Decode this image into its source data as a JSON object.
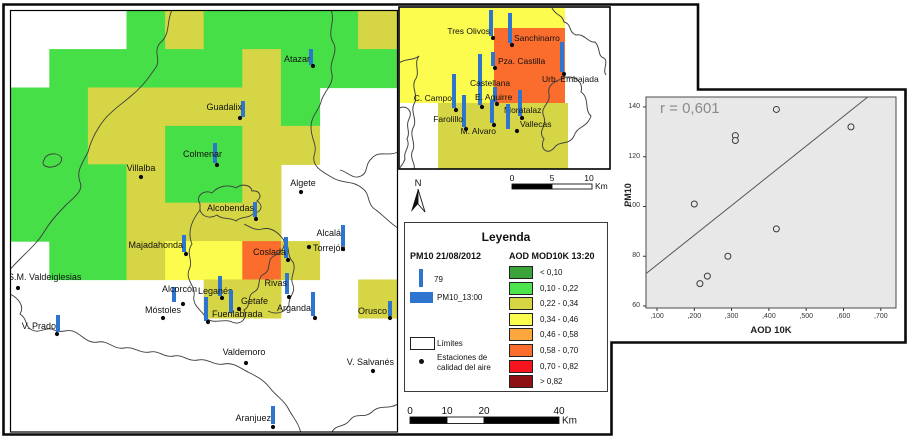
{
  "palette": {
    "G": "#47DF47",
    "Y": "#D6D545",
    "LY": "#FCFC4F",
    "O": "#FA6D2D",
    "bar_blue": "#2E75D0",
    "frame": "#0a0a0a",
    "contour": "#3c3c3c",
    "plot_bg": "#E8E8E8"
  },
  "map": {
    "grid": {
      "origin": [
        11,
        11
      ],
      "cell_w": 38.6,
      "cell_h": 38.4,
      "codes": [
        [
          "W",
          "W",
          "W",
          "G",
          "Y",
          "G",
          "G",
          "G",
          "G",
          "Y"
        ],
        [
          "W",
          "G",
          "G",
          "G",
          "G",
          "G",
          "Y",
          "G",
          "G",
          "G"
        ],
        [
          "G",
          "G",
          "Y",
          "Y",
          "Y",
          "Y",
          "Y",
          "G",
          "W",
          "W"
        ],
        [
          "G",
          "G",
          "Y",
          "Y",
          "G",
          "G",
          "Y",
          "Y",
          "W",
          "W"
        ],
        [
          "G",
          "G",
          "G",
          "Y",
          "G",
          "G",
          "Y",
          "W",
          "W",
          "W"
        ],
        [
          "G",
          "G",
          "G",
          "Y",
          "Y",
          "Y",
          "Y",
          "W",
          "W",
          "W"
        ],
        [
          "W",
          "G",
          "G",
          "Y",
          "LY",
          "LY",
          "O",
          "Y",
          "W",
          "W"
        ],
        [
          "W",
          "W",
          "W",
          "W",
          "W",
          "Y",
          "Y",
          "W",
          "W",
          "Y"
        ],
        [
          "W",
          "W",
          "W",
          "W",
          "W",
          "W",
          "W",
          "W",
          "W",
          "W"
        ],
        [
          "W",
          "W",
          "W",
          "W",
          "W",
          "W",
          "W",
          "W",
          "W",
          "W"
        ],
        [
          "W",
          "W",
          "W",
          "W",
          "W",
          "W",
          "W",
          "W",
          "W",
          "W"
        ]
      ]
    },
    "contours": [
      "M172,10 C166,22 171,34 160,43 C152,53 163,60 154,70 C147,80 141,88 131,96 C122,104 112,110 104,120 C97,129 91,140 88,152 C82,164 76,171 80,182 C84,191 73,198 65,206 C57,214 50,222 44,232 C38,242 29,250 21,258 C15,264 11,268 8,272",
      "M331,10 C336,22 326,32 334,44 C338,54 328,62 332,74 C334,85 323,92 321,102 C318,112 311,116 311,127 C311,140 318,144 314,156 C312,167 323,172 333,178 C343,184 352,180 362,188 C371,194 366,204 376,210 C384,216 391,224 398,228",
      "M398,152 C387,157 380,150 372,158 C364,165 369,172 361,176 C353,180 348,172 340,170",
      "M44,160 C46,153 57,152 61,157 C64,162 56,168 48,167 C43,166 42,163 44,160 Z",
      "M200,204 C195,196 204,189 212,193 C218,186 228,184 236,188 C242,183 251,185 252,191 C259,190 263,196 257,201 C264,205 261,213 254,213 C249,219 241,216 236,221 C230,217 222,220 217,215 C210,219 202,217 200,210 Z",
      "M200,210 C192,220 187,232 192,244 C185,254 194,260 189,270 C185,280 196,286 194,296 C192,306 202,310 206,318 C214,325 224,318 232,322 C241,326 248,318 244,310 C252,306 246,296 254,292 C262,288 256,278 264,274 C272,270 266,260 274,256 C282,252 287,245 283,239 C277,231 270,227 262,229 C256,231 250,227 244,224 M283,239 C291,245 286,256 293,262 C297,270 289,277 293,285 C296,293 288,297 289,305 C285,313 276,315 268,311",
      "M10,294 C18,298 25,306 20,314 C28,319 24,326 32,330 C40,334 46,326 54,330 C62,334 67,328 75,332 C83,336 88,344 98,342 C108,340 114,350 124,348 C134,346 140,354 150,352 C159,350 164,358 174,356 C183,354 188,362 198,360 C208,358 214,366 224,364 C233,362 240,368 248,372 C256,376 264,380 270,388 C276,396 284,400 288,408 C292,416 298,422 300,430 C302,436 304,440 305,442",
      "M398,404 C388,410 380,404 372,412 C364,419 356,412 350,420 C344,428 336,424 332,432 C330,436 330,440 331,442"
    ],
    "stations": [
      {
        "name": "Atazar",
        "dot": [
          313,
          66
        ],
        "bar": [
          311,
          49,
          16
        ],
        "label": [
          310,
          62,
          "end"
        ]
      },
      {
        "name": "Guadalix",
        "dot": [
          240,
          118
        ],
        "bar": [
          243,
          101,
          16
        ],
        "label": [
          242,
          110,
          "end"
        ]
      },
      {
        "name": "Colmenar",
        "dot": [
          217,
          165
        ],
        "bar": [
          215,
          143,
          20
        ],
        "label": [
          222,
          157,
          "end"
        ]
      },
      {
        "name": "Villalba",
        "dot": [
          141,
          177
        ],
        "bar": null,
        "label": [
          141,
          171,
          "middle"
        ]
      },
      {
        "name": "Algete",
        "dot": [
          301,
          192
        ],
        "bar": null,
        "label": [
          303,
          186,
          "middle"
        ]
      },
      {
        "name": "Alcobendas",
        "dot": [
          256,
          219
        ],
        "bar": [
          255,
          202,
          15
        ],
        "label": [
          254,
          211,
          "end"
        ]
      },
      {
        "name": "Majadahonda",
        "dot": [
          186,
          254
        ],
        "bar": [
          184,
          235,
          17
        ],
        "label": [
          183,
          248,
          "end"
        ]
      },
      {
        "name": "Coslada",
        "dot": [
          288,
          260
        ],
        "bar": [
          286,
          237,
          21
        ],
        "label": [
          286,
          255,
          "end"
        ]
      },
      {
        "name": "Alcalá",
        "dot": [
          343,
          249
        ],
        "bar": [
          343,
          225,
          21
        ],
        "label": [
          341,
          236,
          "end"
        ]
      },
      {
        "name": "Torrejón",
        "dot": [
          309,
          247
        ],
        "bar": null,
        "label": [
          313,
          251,
          "start"
        ]
      },
      {
        "name": "Rivas",
        "dot": [
          289,
          297
        ],
        "bar": [
          287,
          273,
          21
        ],
        "label": [
          287,
          286,
          "end"
        ]
      },
      {
        "name": "Alcorcón",
        "dot": [
          183,
          304
        ],
        "bar": [
          174,
          287,
          15
        ],
        "label": [
          197,
          292,
          "end"
        ]
      },
      {
        "name": "Leganés",
        "dot": [
          222,
          298
        ],
        "bar": [
          220,
          276,
          20
        ],
        "label": [
          198,
          294,
          "start"
        ]
      },
      {
        "name": "Getafe",
        "dot": [
          239,
          309
        ],
        "bar": [
          231,
          290,
          23
        ],
        "label": [
          241,
          304,
          "start"
        ]
      },
      {
        "name": "Fuenlabrada",
        "dot": [
          208,
          322
        ],
        "bar": [
          206,
          297,
          24
        ],
        "label": [
          212,
          317,
          "start"
        ]
      },
      {
        "name": "Móstoles",
        "dot": [
          163,
          318
        ],
        "bar": null,
        "label": [
          163,
          313,
          "middle"
        ]
      },
      {
        "name": "Arganda",
        "dot": [
          315,
          318
        ],
        "bar": [
          313,
          292,
          24
        ],
        "label": [
          311,
          311,
          "end"
        ]
      },
      {
        "name": "Orusco",
        "dot": [
          390,
          318
        ],
        "bar": [
          390,
          301,
          15
        ],
        "label": [
          387,
          314,
          "end"
        ]
      },
      {
        "name": "V. Prado",
        "dot": [
          57,
          334
        ],
        "bar": [
          58,
          315,
          17
        ],
        "label": [
          56,
          329,
          "end"
        ]
      },
      {
        "name": "S.M. Valdeiglesias",
        "dot": [
          18,
          288
        ],
        "bar": null,
        "label": [
          8,
          280,
          "start"
        ]
      },
      {
        "name": "Valdemoro",
        "dot": [
          246,
          363
        ],
        "bar": null,
        "label": [
          244,
          355,
          "middle"
        ]
      },
      {
        "name": "V. Salvanés",
        "dot": [
          373,
          371
        ],
        "bar": null,
        "label": [
          394,
          365,
          "end"
        ]
      },
      {
        "name": "Aranjuez",
        "dot": [
          273,
          427
        ],
        "bar": [
          273,
          406,
          18
        ],
        "label": [
          271,
          421,
          "end"
        ]
      }
    ]
  },
  "inset": {
    "patches": [
      {
        "x": 400,
        "y": 8,
        "w": 94,
        "h": 95,
        "c": "LY"
      },
      {
        "x": 494,
        "y": 8,
        "w": 71,
        "h": 20,
        "c": "LY"
      },
      {
        "x": 494,
        "y": 28,
        "w": 71,
        "h": 75,
        "c": "O"
      },
      {
        "x": 438,
        "y": 103,
        "w": 130,
        "h": 66,
        "c": "Y"
      }
    ],
    "contours": [
      "M419,56 C413,64 421,72 415,80 C411,88 419,96 414,104 C410,112 418,120 413,128 C409,136 417,144 412,152 C410,160 416,164 414,169",
      "M399,63 C406,58 413,61 419,56",
      "M552,8 C556,16 562,14 564,22 C572,24 568,32 576,35 C584,33 588,43 595,42 C601,48 597,56 604,58 C609,62 602,70 606,75",
      "M563,78 C574,74 584,82 581,92 C590,98 584,110 591,116 C587,128 577,126 574,136 C569,146 559,140 554,148 C547,156 539,148 544,139 C537,131 547,127 544,117 C539,107 551,104 549,94 C547,84 555,82 563,78 Z",
      "M399,108 C407,105 413,111 409,119 C405,127 411,131 407,139 C411,147 403,151 405,159 C403,165 400,167 399,169"
    ],
    "stations": [
      {
        "name": "Tres Olivos",
        "dot": [
          493,
          38
        ],
        "bar": [
          491,
          10,
          26
        ],
        "label": [
          490,
          34,
          "end"
        ]
      },
      {
        "name": "Sanchinarro",
        "dot": [
          512,
          45
        ],
        "bar": [
          510,
          13,
          30
        ],
        "label": [
          514,
          41,
          "start"
        ]
      },
      {
        "name": "Pza. Castilla",
        "dot": [
          495,
          68
        ],
        "bar": [
          493,
          52,
          14
        ],
        "label": [
          498,
          64,
          "start"
        ]
      },
      {
        "name": "Urb. Embajada",
        "dot": [
          564,
          74
        ],
        "bar": [
          562,
          42,
          30
        ],
        "label": [
          542,
          82,
          "start"
        ]
      },
      {
        "name": "Castellana",
        "dot": [
          482,
          107
        ],
        "bar": [
          480,
          54,
          51
        ],
        "label": [
          470,
          86,
          "start"
        ]
      },
      {
        "name": "C. Campo",
        "dot": [
          456,
          110
        ],
        "bar": [
          454,
          74,
          34
        ],
        "label": [
          452,
          101,
          "end"
        ]
      },
      {
        "name": "E. Aguirre",
        "dot": [
          497,
          104
        ],
        "bar": [
          495,
          87,
          15
        ],
        "label": [
          475,
          100,
          "start"
        ]
      },
      {
        "name": "Farolillo",
        "dot": [
          466,
          129
        ],
        "bar": [
          464,
          95,
          32
        ],
        "label": [
          463,
          122,
          "end"
        ]
      },
      {
        "name": "M. Alvaro",
        "dot": [
          494,
          125
        ],
        "bar": [
          492,
          100,
          23
        ],
        "label": [
          496,
          134,
          "end"
        ]
      },
      {
        "name": "Moratalaz",
        "dot": [
          522,
          118
        ],
        "bar": [
          520,
          90,
          26
        ],
        "label": [
          504,
          113,
          "start"
        ]
      },
      {
        "name": "Vallecas",
        "dot": [
          517,
          131
        ],
        "bar": [
          508,
          104,
          25
        ],
        "label": [
          520,
          127,
          "start"
        ]
      }
    ]
  },
  "north": {
    "label": "N"
  },
  "scalebar_top": {
    "ticks": [
      {
        "t": "0",
        "x": 512
      },
      {
        "t": "5",
        "x": 552
      },
      {
        "t": "10",
        "x": 589
      }
    ],
    "km": "Km",
    "segments": [
      {
        "x": 512,
        "w": 40,
        "fill": "black"
      },
      {
        "x": 552,
        "w": 40,
        "fill": "white"
      }
    ],
    "y": 184,
    "h": 5
  },
  "scalebar_bottom": {
    "ticks": [
      {
        "t": "0",
        "x": 410
      },
      {
        "t": "10",
        "x": 447
      },
      {
        "t": "20",
        "x": 484
      },
      {
        "t": "40",
        "x": 559
      }
    ],
    "km": "Km",
    "segments": [
      {
        "x": 410,
        "w": 37,
        "fill": "black"
      },
      {
        "x": 447,
        "w": 37,
        "fill": "white"
      },
      {
        "x": 484,
        "w": 75,
        "fill": "black"
      }
    ],
    "y": 417,
    "h": 6.5
  },
  "legend": {
    "title": "Leyenda",
    "pm10_header": "PM10 21/08/2012",
    "pm10_bar_value": "79",
    "pm10_rect_label": "PM10_13:00",
    "limits_label": "Límites",
    "stations_line1": "Estaciones de",
    "stations_line2": "calidad del aire",
    "aod_header": "AOD MOD10K 13:20",
    "classes": [
      {
        "color": "#3AA33A",
        "label": "< 0,10"
      },
      {
        "color": "#4CE44C",
        "label": "0,10 - 0,22"
      },
      {
        "color": "#D6D645",
        "label": "0,22 - 0,34"
      },
      {
        "color": "#FCFC4F",
        "label": "0,34 - 0,46"
      },
      {
        "color": "#FBA73D",
        "label": "0,46 - 0,58"
      },
      {
        "color": "#FA6D2D",
        "label": "0,58 - 0,70"
      },
      {
        "color": "#F5141E",
        "label": "0,70 - 0,82"
      },
      {
        "color": "#8E1014",
        "label": "> 0,82"
      }
    ]
  },
  "chart_data": {
    "type": "scatter",
    "r_label": "r = 0,601",
    "xlabel": "AOD 10K",
    "ylabel": "PM10",
    "x_ticks": {
      "values": [
        0.1,
        0.2,
        0.3,
        0.4,
        0.5,
        0.6,
        0.7
      ],
      "labels": [
        ",100",
        ",200",
        ",300",
        ",400",
        ",500",
        ",600",
        ",700"
      ]
    },
    "y_ticks": {
      "values": [
        60,
        80,
        100,
        120,
        140
      ],
      "labels": [
        "60",
        "80",
        "100",
        "120",
        "140"
      ]
    },
    "xlim": [
      0.0705,
      0.7407
    ],
    "ylim": [
      59.2,
      144.0
    ],
    "points": [
      [
        0.2,
        101
      ],
      [
        0.215,
        69
      ],
      [
        0.235,
        72
      ],
      [
        0.29,
        80
      ],
      [
        0.31,
        128.5
      ],
      [
        0.31,
        126.5
      ],
      [
        0.42,
        139
      ],
      [
        0.42,
        91
      ],
      [
        0.62,
        132
      ]
    ],
    "fit_line": [
      [
        0.0705,
        73
      ],
      [
        0.665,
        144
      ]
    ],
    "legend_position": "none",
    "grid": false
  }
}
